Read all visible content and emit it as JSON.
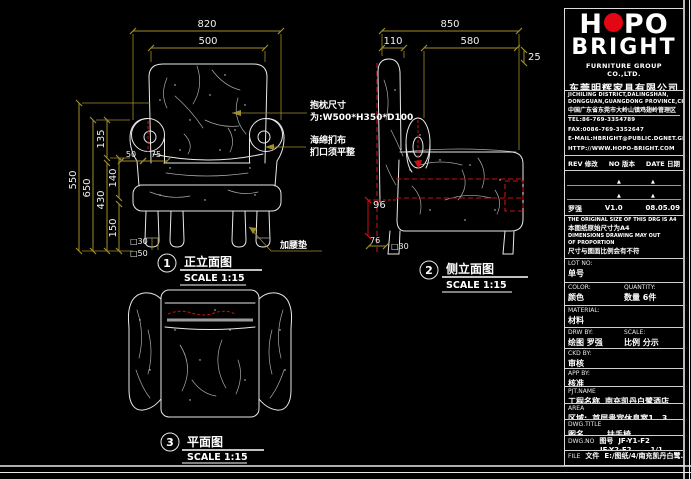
{
  "brand": {
    "logo_part1": "H",
    "logo_part2": "PO",
    "logo_line2": "BRIGHT",
    "company_en": "FURNITURE GROUP CO.,LTD.",
    "company_cn": "东莞明辉家具有限公司",
    "addr_en1": "JICHILING DISTRICT,DALINGSHAN,",
    "addr_en2": "DONGGUAN,GUANGDONG PROVINCE,CHINA",
    "addr_cn": "中国广东省东莞市大岭山镇鸡翅岭管理区",
    "tel": "TEL:86-769-3354789",
    "fax": "FAX:0086-769-3352647",
    "email": "E-MAIL:HBRIGHT@PUBLIC.DGNET.GD.CN",
    "web": "HTTP://WWW.HOPO-BRIGHT.COM"
  },
  "revision": {
    "col1": "REV 修改",
    "col2": "NO 版本",
    "col3": "DATE 日期",
    "name": "罗强",
    "version": "V1.0",
    "date": "08.05.09"
  },
  "notes": {
    "en1": "THE ORIGINAL SIZE OF THIS DRG IS A4",
    "cn1": "本图纸原始尺寸为A4",
    "en2": "DIMENSIONS DRAWING MAY OUT",
    "en3": "OF PROPORTION",
    "cn2": "尺寸与图面比例会有不符"
  },
  "fields": {
    "lot": {
      "label": "LOT NO:",
      "value": "单号"
    },
    "color": {
      "label": "COLOR:",
      "value": "颜色"
    },
    "quantity": {
      "label": "QUANTITY:",
      "value": "数量  6件"
    },
    "material": {
      "label": "MATERIAL:",
      "value": "材料"
    },
    "drw": {
      "label": "DRW BY:",
      "value": "绘图  罗强"
    },
    "scale": {
      "label": "SCALE:",
      "value": "比例  分示"
    },
    "ckd": {
      "label": "CKD BY:",
      "value": "审核"
    },
    "app": {
      "label": "APP BY:",
      "value": "核准"
    },
    "pjt": {
      "label": "PJT.NAME",
      "label_cn": "工程名称",
      "value": "南充凯丹白鹭酒店"
    },
    "area": {
      "label": "AREA",
      "label_cn": "区域:",
      "value": "首层贵宾休息室1、3"
    },
    "dwg_title": {
      "label": "DWG.TITLE",
      "label_cn": "图名",
      "value": "扶手椅"
    },
    "dwg_no": {
      "label": "DWG.NO",
      "label_cn": "图号",
      "value1": "JF-Y1-F2",
      "value2": "JF-Y2-F2",
      "sheet": "1/1"
    },
    "file": {
      "label": "FILE",
      "label_cn": "文件",
      "value": "E:/图纸/4/南充凯丹白鹭..."
    }
  },
  "views": [
    {
      "num": "1",
      "title": "正立面图",
      "scale": "SCALE 1:15"
    },
    {
      "num": "2",
      "title": "侧立面图",
      "scale": "SCALE 1:15"
    },
    {
      "num": "3",
      "title": "平面图",
      "scale": "SCALE 1:15"
    }
  ],
  "dims": {
    "front": {
      "overall_width": "820",
      "back_width": "500",
      "height_outer": "550",
      "height_inner": "650",
      "seg_135": "135",
      "seg_140": "140",
      "seg_430": "430",
      "seg_150": "150",
      "arm_50": "50",
      "arm_75": "75",
      "leg_30": "□30",
      "leg_50": "□50"
    },
    "side": {
      "overall_depth": "850",
      "back_110": "110",
      "seat_580": "580",
      "top_25": "25",
      "h_96": "96",
      "leg_76": "76",
      "leg_sq30": "□30"
    }
  },
  "annotations": {
    "pillow_1": "抱枕尺寸",
    "pillow_2": "为:W500*H350*D100",
    "fabric_1": "海绵扪布",
    "fabric_2": "扪口须平整",
    "lumbar": "加腰垫"
  }
}
